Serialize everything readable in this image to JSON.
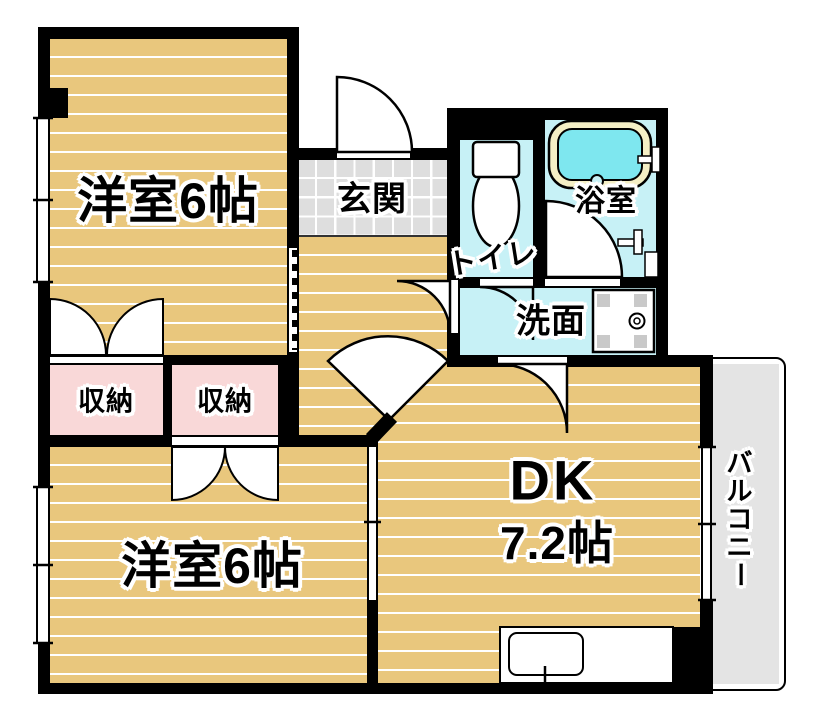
{
  "plan_title": "2DK apartment floor plan",
  "rooms": {
    "west_room_top": {
      "label": "洋室6帖"
    },
    "entrance": {
      "label": "玄関"
    },
    "toilet": {
      "label": "トイレ"
    },
    "bathroom": {
      "label": "浴室"
    },
    "washroom": {
      "label": "洗面"
    },
    "closet_left": {
      "label": "収納"
    },
    "closet_right": {
      "label": "収納"
    },
    "west_room_bottom": {
      "label": "洋室6帖"
    },
    "dining_kitchen": {
      "label": "DK",
      "size": "7.2帖"
    },
    "balcony": {
      "label": "バルコニー"
    }
  },
  "colors": {
    "wall": "#000000",
    "floor_wood": "#e9c77d",
    "floor_stripe": "#ffffff",
    "closet_pink": "#f9d8d8",
    "wet_area_cyan": "#c7f1f6",
    "bathtub_water": "#7ee7ef",
    "bathtub_rim": "#f4efc5",
    "entrance_tile": "#dedede",
    "balcony_gray": "#e4e4e4"
  }
}
